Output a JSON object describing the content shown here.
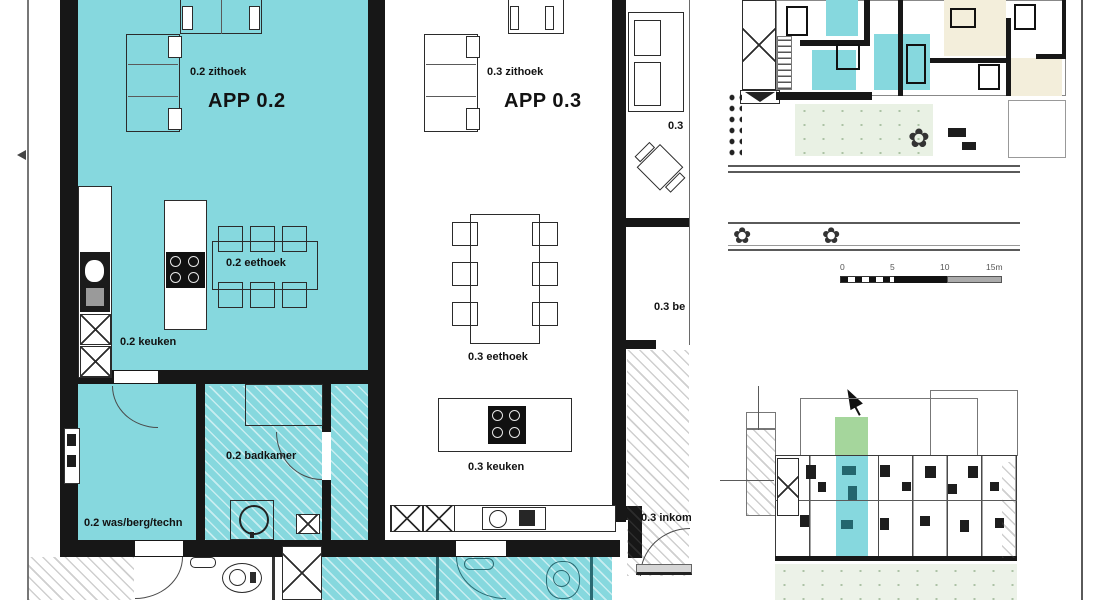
{
  "plan": {
    "app2": {
      "title": "APP 0.2",
      "zithoek": "0.2 zithoek",
      "eethoek": "0.2 eethoek",
      "keuken": "0.2 keuken",
      "badkamer": "0.2 badkamer",
      "wasberg": "0.2 was/berg/techn"
    },
    "app3": {
      "title": "APP 0.3",
      "zithoek": "0.3 zithoek",
      "eethoek": "0.3 eethoek",
      "keuken": "0.3 keuken",
      "inkom": "0.3 inkom",
      "side": "0.3",
      "berging": "0.3 be"
    },
    "scale_bar": {
      "ticks": [
        "0",
        "5",
        "10",
        "15m"
      ]
    },
    "colors": {
      "highlight_cyan": "#86D8DE",
      "site_green": "#A5D69C",
      "site_cream": "#F3EEDB",
      "wall_black": "#171717"
    }
  }
}
